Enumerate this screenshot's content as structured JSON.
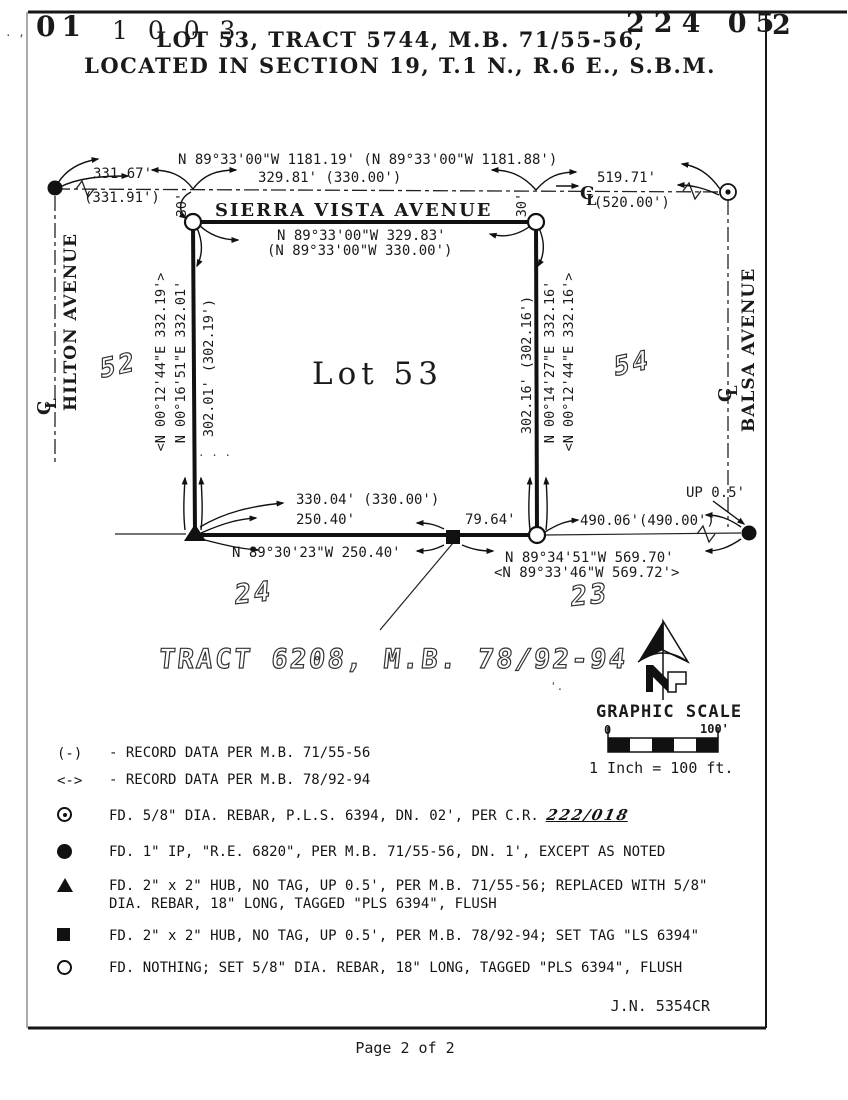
{
  "page": {
    "header_left_num": "01",
    "header_left_num2": "1 0 0 3",
    "header_right_num": "224  05",
    "header_corner_num": "2",
    "title_line1": "LOT 53, TRACT 5744, M.B. 71/55-56,",
    "title_line2": "LOCATED IN SECTION 19, T.1 N., R.6 E., S.B.M.",
    "job_number": "J.N. 5354CR",
    "footer": "Page 2 of 2"
  },
  "map": {
    "streets": {
      "top": "SIERRA VISTA AVENUE",
      "left": "HILTON AVENUE",
      "right": "BALSA AVENUE"
    },
    "lot_label": "Lot 53",
    "adjacent_lots": {
      "west": "52",
      "east": "54",
      "southwest": "24",
      "southeast": "23"
    },
    "tract_note": "TRACT 6208, M.B. 78/92-94",
    "cl_c": "C",
    "cl_l": "L",
    "dims": {
      "north_total": "N 89°33'00\"W  1181.19'   (N 89°33'00\"W  1181.88')",
      "north_west_seg": "331.67'",
      "north_west_seg_record": "(331.91')",
      "north_mid_seg": "329.81'   (330.00')",
      "north_east_seg": "519.71'",
      "north_east_seg_record": "(520.00')",
      "lot_north": "N 89°33'00\"W  329.83'",
      "lot_north_record": "(N 89°33'00\"W  330.00')",
      "offset_left": "30'",
      "offset_right": "30'",
      "west_record": "<N 00°12'44\"E  332.19'>",
      "west_bearing": "N 00°16'51\"E  332.01'",
      "west_dist": "302.01'   (302.19')",
      "east_dist": "302.16'   (302.16')",
      "east_bearing": "N 00°14'27\"E  332.16'",
      "east_record": "<N 00°12'44\"E  332.16'>",
      "south_lot": "330.04'   (330.00')",
      "south_west_seg": "250.40'",
      "south_mid_seg": "79.64'",
      "south_bearing": "N 89°30'23\"W  250.40'",
      "south_total": "N 89°34'51\"W  569.70'",
      "south_total_record": "<N 89°33'46\"W  569.72'>",
      "south_east_seg": "490.06'(490.00')",
      "up_note": "UP 0.5'"
    }
  },
  "legend": {
    "items": [
      {
        "label": "(-)",
        "text": "- RECORD DATA PER M.B. 71/55-56"
      },
      {
        "label": "<->",
        "text": "- RECORD DATA PER M.B. 78/92-94"
      },
      {
        "text": "FD. 5/8\" DIA. REBAR, P.L.S. 6394, DN. 02', PER C.R.",
        "handwritten": "222/018"
      },
      {
        "text": "FD. 1\" IP, \"R.E. 6820\", PER M.B. 71/55-56, DN. 1', EXCEPT AS NOTED"
      },
      {
        "text": "FD. 2\" x 2\" HUB, NO TAG, UP 0.5', PER M.B. 71/55-56; REPLACED WITH 5/8\"",
        "text2": "DIA. REBAR, 18\" LONG, TAGGED \"PLS 6394\", FLUSH"
      },
      {
        "text": "FD.  2\" x 2\" HUB, NO TAG, UP 0.5', PER M.B. 78/92-94; SET TAG \"LS 6394\""
      },
      {
        "text": "FD. NOTHING; SET 5/8\" DIA. REBAR, 18\" LONG, TAGGED \"PLS 6394\", FLUSH"
      }
    ]
  },
  "scale": {
    "title": "GRAPHIC SCALE",
    "tick0": "0",
    "tick100": "100'",
    "caption": "1 Inch = 100 ft."
  },
  "noise": [
    ". ,",
    ". . .",
    "'."
  ]
}
